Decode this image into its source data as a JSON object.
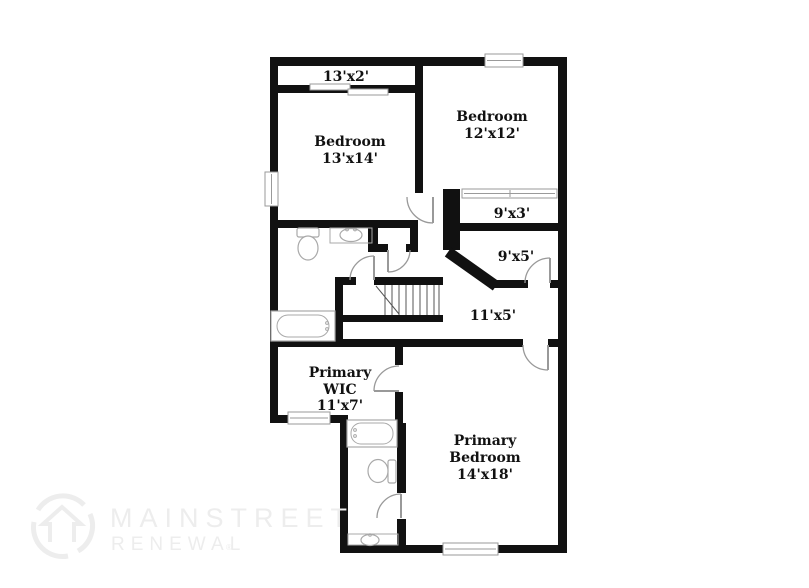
{
  "floorplan": {
    "rooms": [
      {
        "id": "closet-13x2",
        "line1": "13'x2'",
        "line2": "",
        "line3": ""
      },
      {
        "id": "bedroom-13x14",
        "line1": "Bedroom",
        "line2": "13'x14'",
        "line3": ""
      },
      {
        "id": "bedroom-12x12",
        "line1": "Bedroom",
        "line2": "12'x12'",
        "line3": ""
      },
      {
        "id": "closet-9x3",
        "line1": "9'x3'",
        "line2": "",
        "line3": ""
      },
      {
        "id": "closet-9x5",
        "line1": "9'x5'",
        "line2": "",
        "line3": ""
      },
      {
        "id": "hall-11x5",
        "line1": "11'x5'",
        "line2": "",
        "line3": ""
      },
      {
        "id": "primary-wic",
        "line1": "Primary",
        "line2": "WIC",
        "line3": "11'x7'"
      },
      {
        "id": "primary-bedroom",
        "line1": "Primary",
        "line2": "Bedroom",
        "line3": "14'x18'"
      }
    ]
  },
  "watermark": {
    "line1": "MAINSTREET",
    "line2": "RENEWAL",
    "reg": "®"
  },
  "colors": {
    "wall": "#111111",
    "door": "#999999",
    "fixture": "#a9a9a9",
    "watermark": "#ededed",
    "background": "#ffffff",
    "label": "#111111"
  }
}
